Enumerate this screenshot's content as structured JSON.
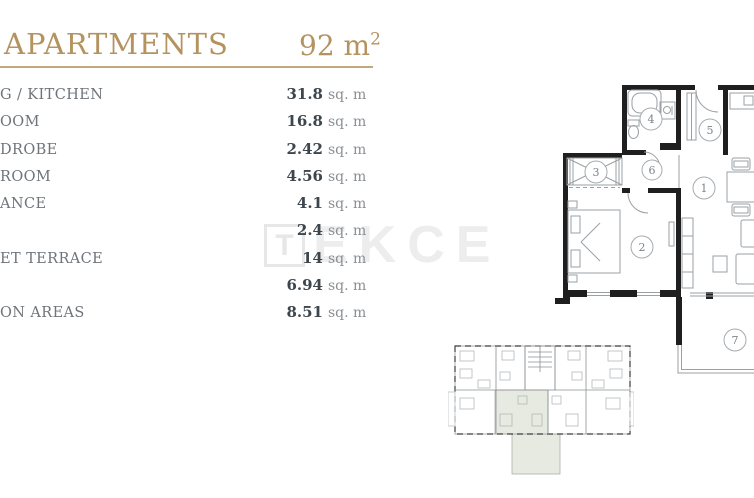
{
  "header": {
    "title": "APARTMENTS",
    "area_value": "92 m",
    "area_sup": "2"
  },
  "room_list": {
    "rows": [
      {
        "label": "G / KITCHEN",
        "value": "31.8",
        "unit": "sq. m"
      },
      {
        "label": "OOM",
        "value": "16.8",
        "unit": "sq. m"
      },
      {
        "label": "DROBE",
        "value": "2.42",
        "unit": "sq. m"
      },
      {
        "label": "ROOM",
        "value": "4.56",
        "unit": "sq. m"
      },
      {
        "label": "ANCE",
        "value": "4.1",
        "unit": "sq. m"
      },
      {
        "label": "",
        "value": "2.4",
        "unit": "sq. m"
      },
      {
        "label": "ET TERRACE",
        "value": "14",
        "unit": "sq. m"
      },
      {
        "label": "",
        "value": "6.94",
        "unit": "sq. m"
      },
      {
        "label": "ON AREAS",
        "value": "8.51",
        "unit": "sq. m"
      }
    ]
  },
  "watermark": {
    "logo_letter": "T",
    "text": "EKCE"
  },
  "floorplan": {
    "room_numbers": [
      "1",
      "2",
      "3",
      "4",
      "5",
      "6",
      "7"
    ]
  },
  "colors": {
    "gold": "#b4935f",
    "rule": "#c3a87c",
    "label_gray": "#6e747a",
    "value_dark": "#3e464d",
    "unit_gray": "#8a8f93",
    "wall_black": "#1f1f1f",
    "thin_line": "#9aa0a4",
    "keyplan_highlight": "#e7eae0",
    "watermark_gray": "#ededee"
  }
}
